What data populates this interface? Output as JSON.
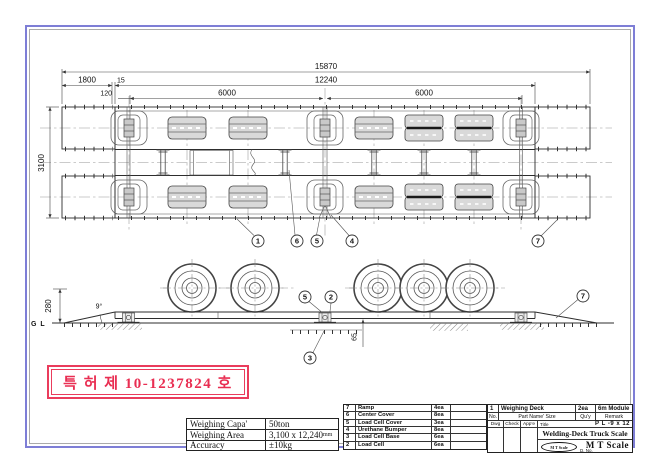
{
  "frame": {
    "border_color": "#7e7ed6"
  },
  "plan_view": {
    "dim_overall": "15870",
    "dim_deck_length": "12240",
    "dim_ramp_length": "1800",
    "dim_gap": "15",
    "dim_edge_offset": "120",
    "dim_module_left": "6000",
    "dim_module_right": "6000",
    "dim_deck_width": "3100",
    "callout_ramp_left": "1",
    "callout_center_cover": "6",
    "callout_loadcell_cover": "5",
    "callout_urethane_bumper": "4",
    "callout_ramp_right": "7"
  },
  "side_view": {
    "ground_label": "G L",
    "dim_height": "280",
    "dim_ramp_angle": "9°",
    "dim_pit_depth": "65",
    "callout_loadcell_cover": "5",
    "callout_loadcell": "2",
    "callout_loadcell_base": "3",
    "callout_ramp": "7"
  },
  "patent_stamp": {
    "text": "특 허 제 10-1237824 호",
    "color": "#e92e52"
  },
  "spec_table": {
    "rows": [
      {
        "label": "Weighing Capa'",
        "value": "50ton",
        "unit": ""
      },
      {
        "label": "Weighing Area",
        "value": "3,100 x 12,240",
        "unit": "mm"
      },
      {
        "label": "Accuracy",
        "value": "±10kg",
        "unit": ""
      }
    ]
  },
  "parts_table": {
    "rows": [
      {
        "no": "7",
        "name": "Ramp",
        "qty": "4ea"
      },
      {
        "no": "6",
        "name": "Center Cover",
        "qty": "8ea"
      },
      {
        "no": "5",
        "name": "Load Cell Cover",
        "qty": "3ea"
      },
      {
        "no": "4",
        "name": "Urethane Bumper",
        "qty": "8ea"
      },
      {
        "no": "3",
        "name": "Load Cell Base",
        "qty": "6ea"
      },
      {
        "no": "2",
        "name": "Load Cell",
        "qty": "6ea"
      }
    ]
  },
  "title_block": {
    "item": {
      "no": "1",
      "name": "Weighing Deck",
      "qty": "2ea",
      "remark": "6m Module"
    },
    "headers": {
      "no": "No.",
      "name": "Part Name' Size",
      "qty": "Qu'y",
      "remark": "Remark"
    },
    "sign": {
      "dwg": "Dwg",
      "check": "Check",
      "appe": "App'e"
    },
    "title_label": "Title",
    "plate_spec": "P L -9 x 12",
    "drawing_title": "Welding-Deck Truck Scale",
    "company": "M T Scale",
    "logo_text": "M T Scale",
    "doc_no_label": "D. No."
  }
}
